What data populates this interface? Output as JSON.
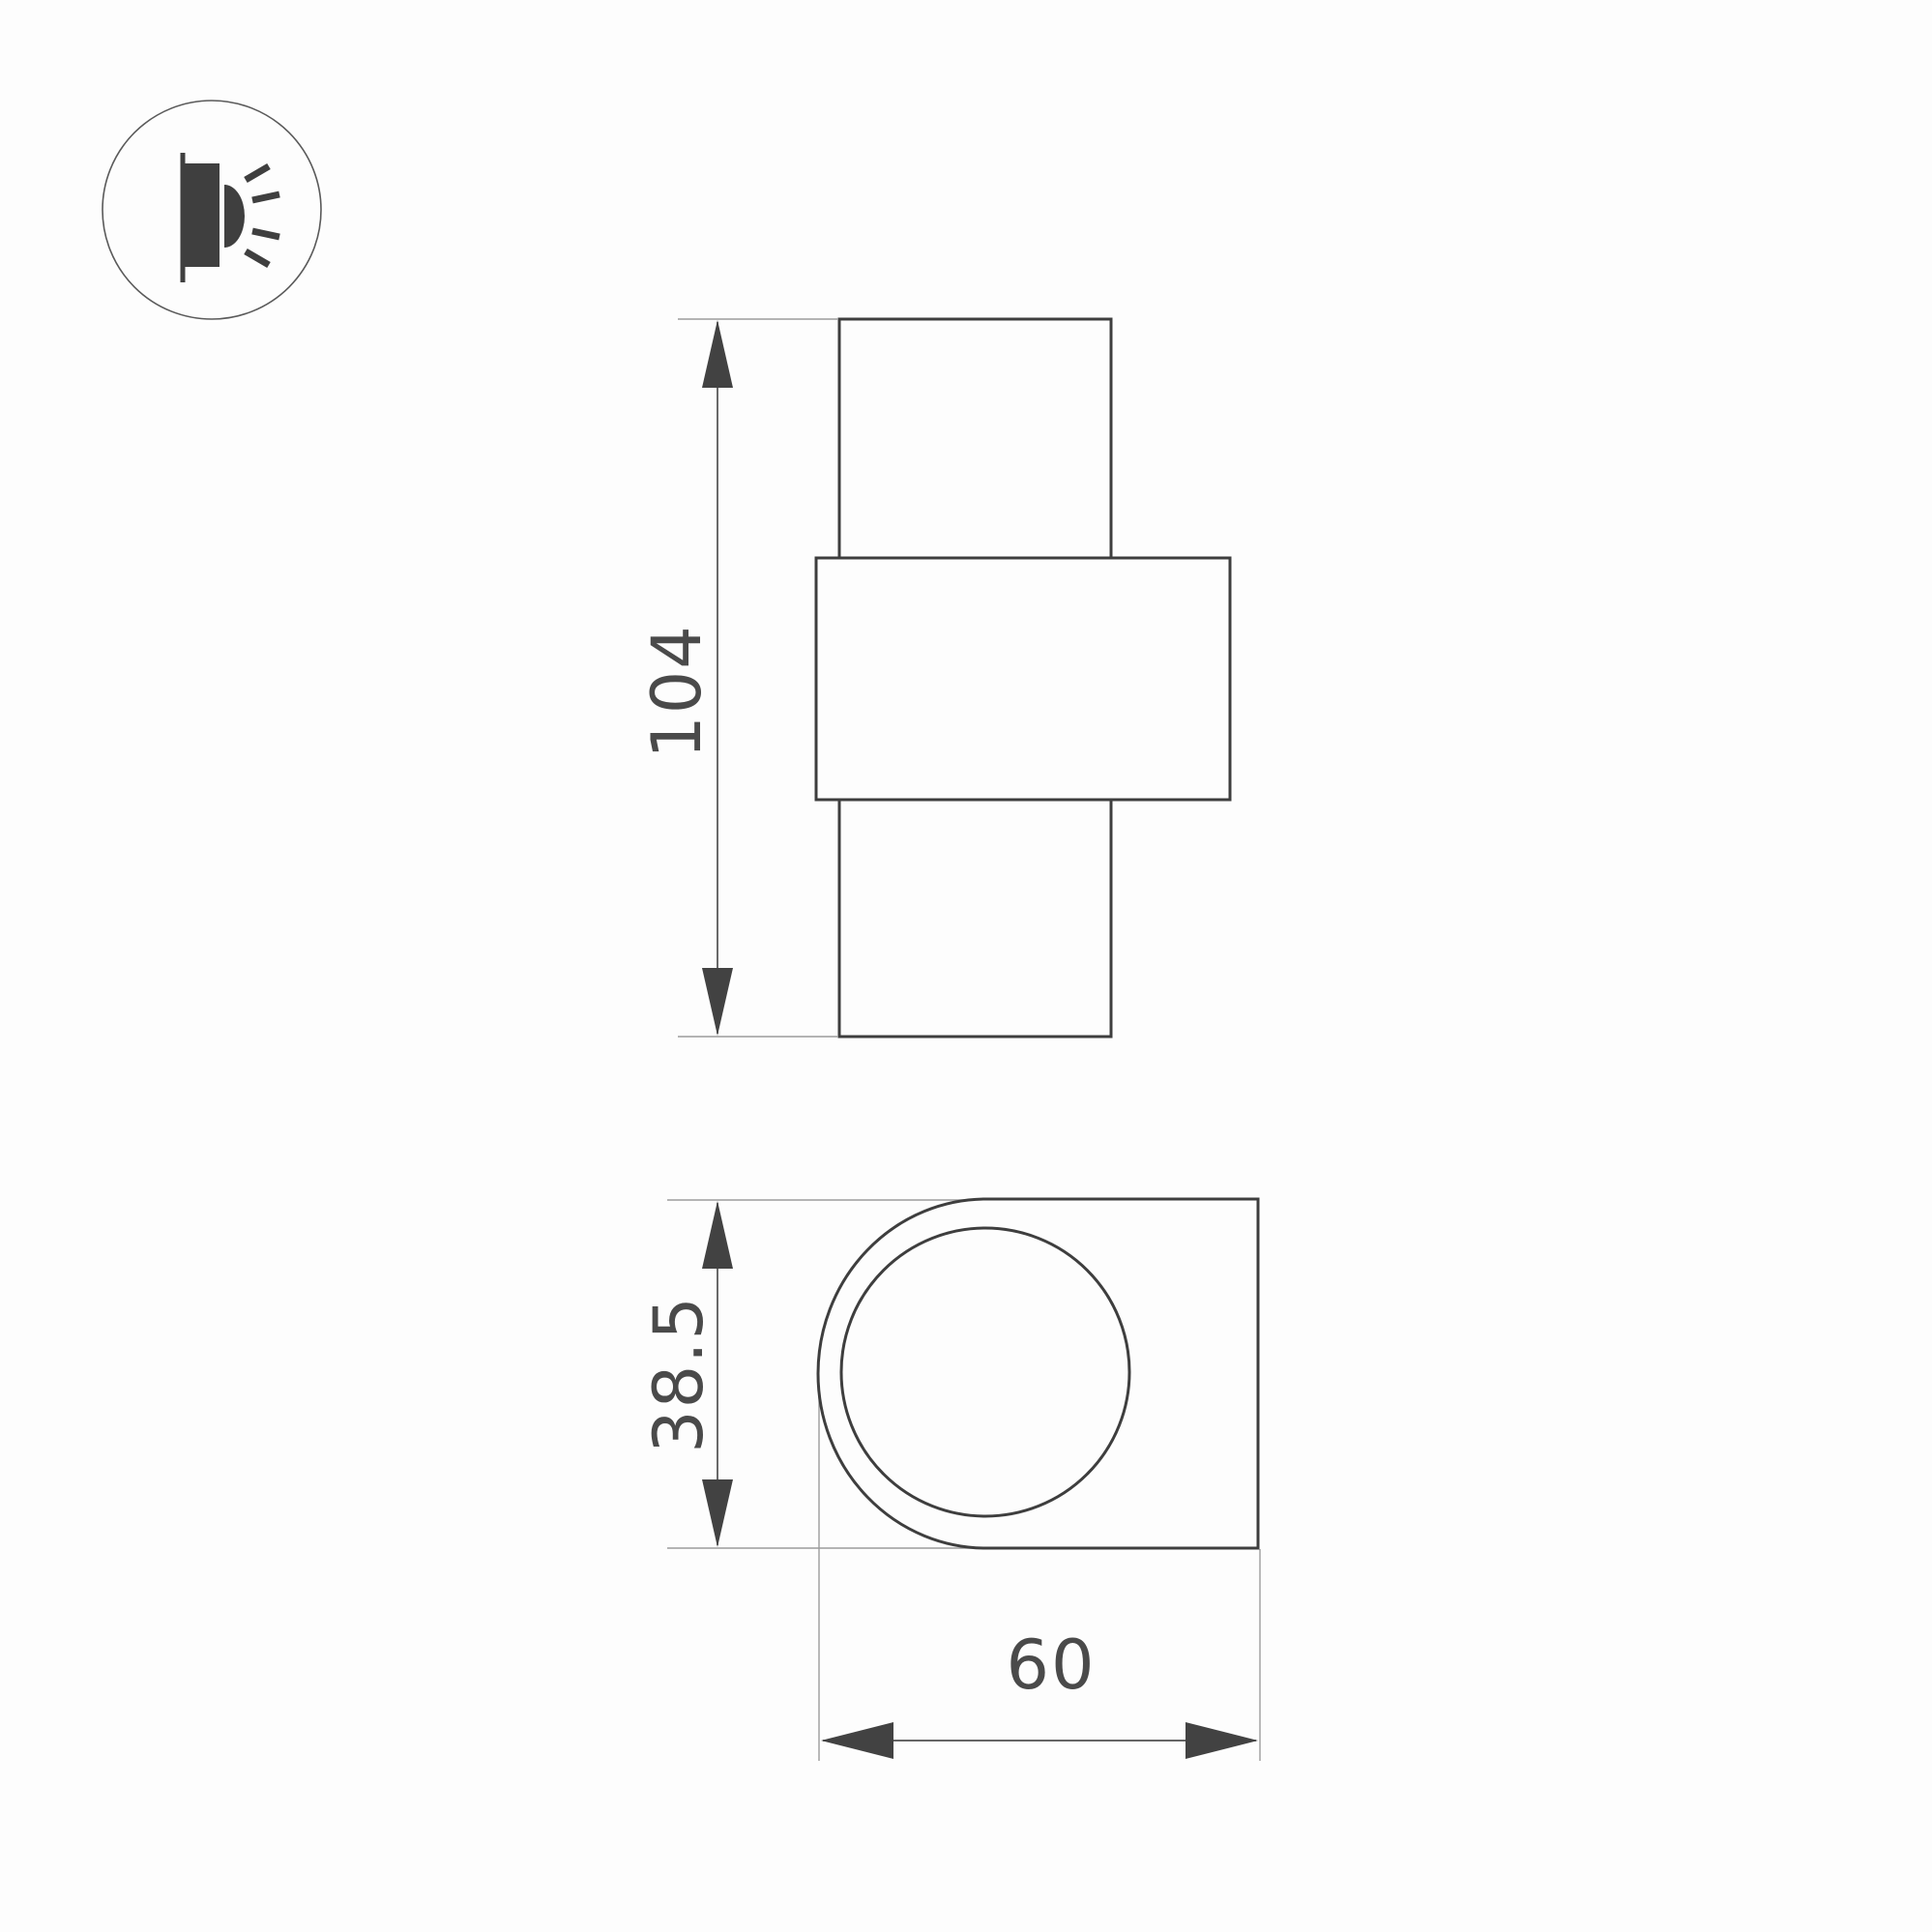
{
  "page": {
    "background": "#fdfdfd"
  },
  "colors": {
    "page_bg": "#fdfdfd",
    "outline": "#3e3e3e",
    "dim": "#4f4f4f",
    "ext": "#9c9c9c",
    "arrow": "#424242",
    "label": "#4a4a4a",
    "icon": "#3f3f3f",
    "icon_ring": "#5a5a5a"
  },
  "icon": {
    "type": "wall-light-icon"
  },
  "front_view": {
    "name": "front-view",
    "height_label": "104"
  },
  "side_view": {
    "name": "side-view",
    "height_label": "38.5",
    "width_label": "60"
  }
}
